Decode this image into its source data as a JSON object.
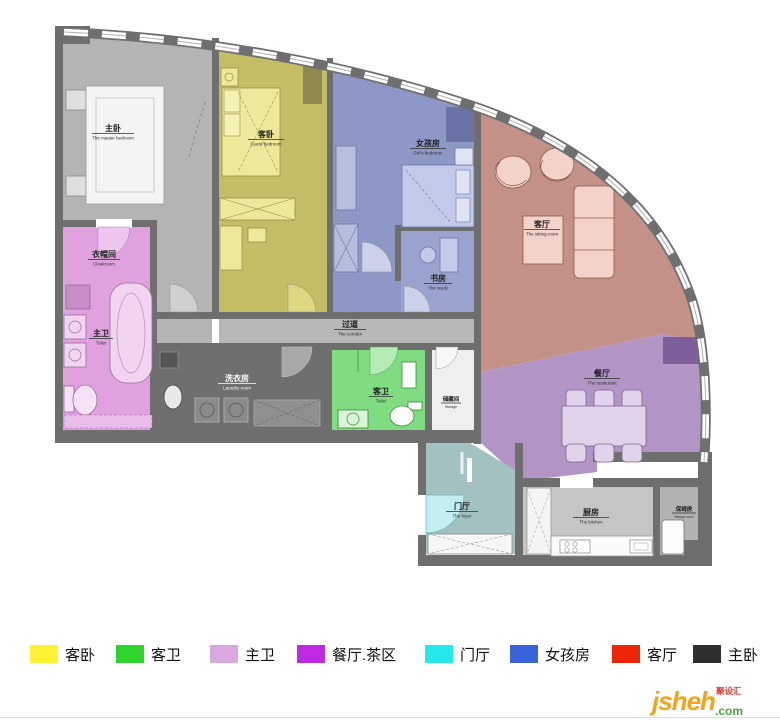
{
  "plan": {
    "rooms": {
      "master_bedroom": {
        "zh": "主卧",
        "en": "The master bedroom",
        "color": "#b4b4b4"
      },
      "guest_bedroom": {
        "zh": "客卧",
        "en": "Guest bedroom",
        "color": "#c5bc66"
      },
      "girls_room": {
        "zh": "女孩房",
        "en": "Girl's bedroom",
        "color": "#8e98c7"
      },
      "study": {
        "zh": "书房",
        "en": "The study",
        "color": "#9aa3cf"
      },
      "living_room": {
        "zh": "客厅",
        "en": "The sitting room",
        "color": "#c39188"
      },
      "dining_room": {
        "zh": "餐厅",
        "en": "The restaurant",
        "color": "#b295c5"
      },
      "corridor": {
        "zh": "过道",
        "en": "The corridor",
        "color": "#b7b7b7"
      },
      "cloakroom": {
        "zh": "衣帽间",
        "en": "Cloakroom"
      },
      "master_bath": {
        "zh": "主卫",
        "en": "Toilet",
        "color": "#dfa2df"
      },
      "laundry": {
        "zh": "洗衣房",
        "en": "Laundry room",
        "color": "#6f6f6f"
      },
      "guest_bath": {
        "zh": "客卫",
        "en": "Toilet",
        "color": "#80dc80"
      },
      "storage": {
        "zh": "储藏间",
        "en": "Storage",
        "color": "#efefef"
      },
      "foyer": {
        "zh": "门厅",
        "en": "The foyer",
        "color": "#a4c1c1"
      },
      "kitchen": {
        "zh": "厨房",
        "en": "The kitchen",
        "color": "#c5c5c5"
      },
      "nanny_room": {
        "zh": "保姆房",
        "en": "Nanny room",
        "color": "#b2b2b2"
      }
    }
  },
  "legend": {
    "items": [
      {
        "label": "客卧",
        "color": "#FFF133"
      },
      {
        "label": "客卫",
        "color": "#2ED32E"
      },
      {
        "label": "主卫",
        "color": "#D9A8DF"
      },
      {
        "label": "餐厅.茶区",
        "color": "#BF2BE2"
      },
      {
        "label": "门厅",
        "color": "#25E9E9"
      },
      {
        "label": "女孩房",
        "color": "#3A63DC"
      },
      {
        "label": "客厅",
        "color": "#EE2605"
      },
      {
        "label": "主卧",
        "color": "#2F2F2F"
      }
    ]
  },
  "watermark": {
    "brand": "jsheh",
    "suffix": ".com",
    "tag": "聚设汇",
    "brand_color": "#F6A21B",
    "suffix_color": "#44A73E",
    "tag_color": "#E03A2F"
  }
}
